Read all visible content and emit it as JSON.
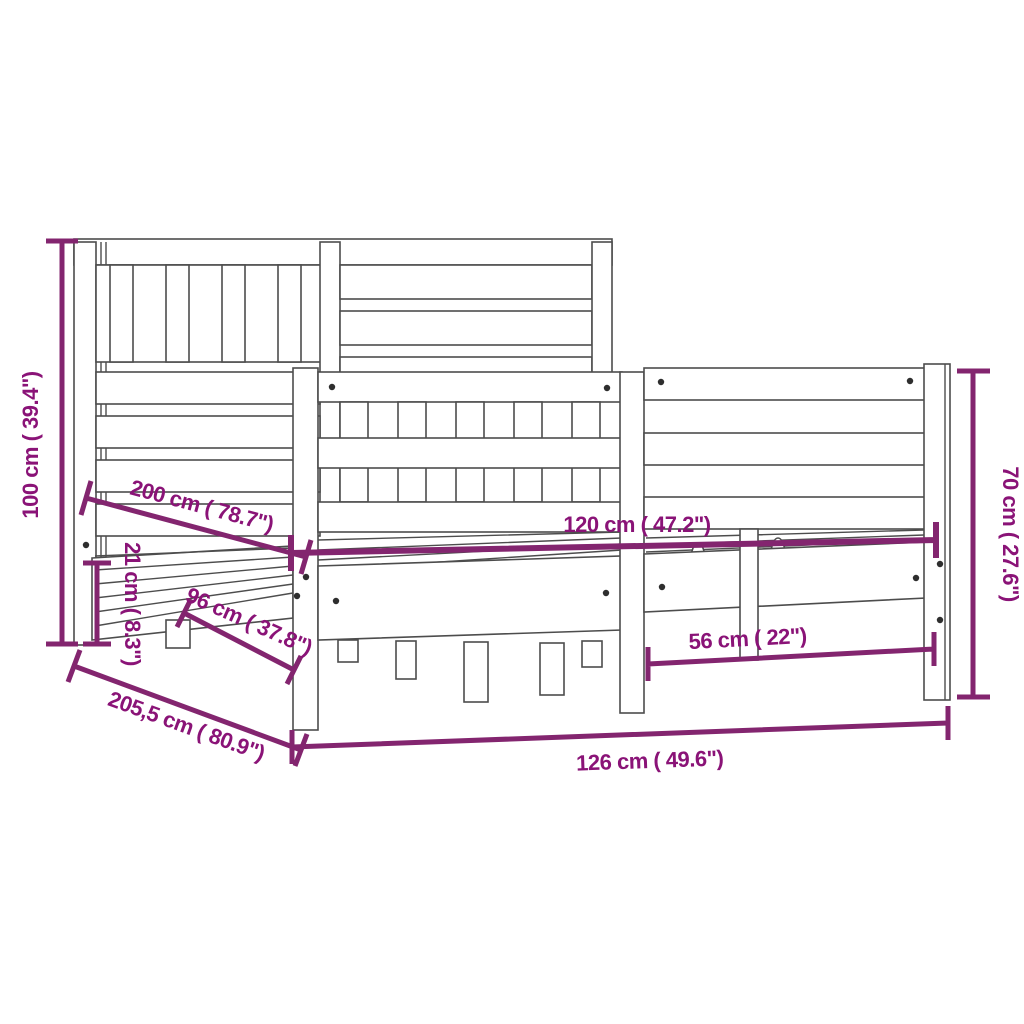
{
  "title": "Bed frame dimension diagram",
  "colors": {
    "dimension_line": "#83256F",
    "dimension_text": "#8A1377",
    "drawing_line": "#4D4D4D",
    "background": "#FFFFFF"
  },
  "dimensions": {
    "h100": "100 cm ( 39.4\")",
    "l200": "200 cm ( 78.7\")",
    "c21": "21 cm ( 8.3\")",
    "d96": "96 cm ( 37.8\")",
    "t205": "205,5 cm ( 80.9\")",
    "w120": "120 cm ( 47.2\")",
    "w56": "56 cm ( 22\")",
    "h70": "70 cm ( 27.6\")",
    "w126": "126 cm ( 49.6\")"
  }
}
